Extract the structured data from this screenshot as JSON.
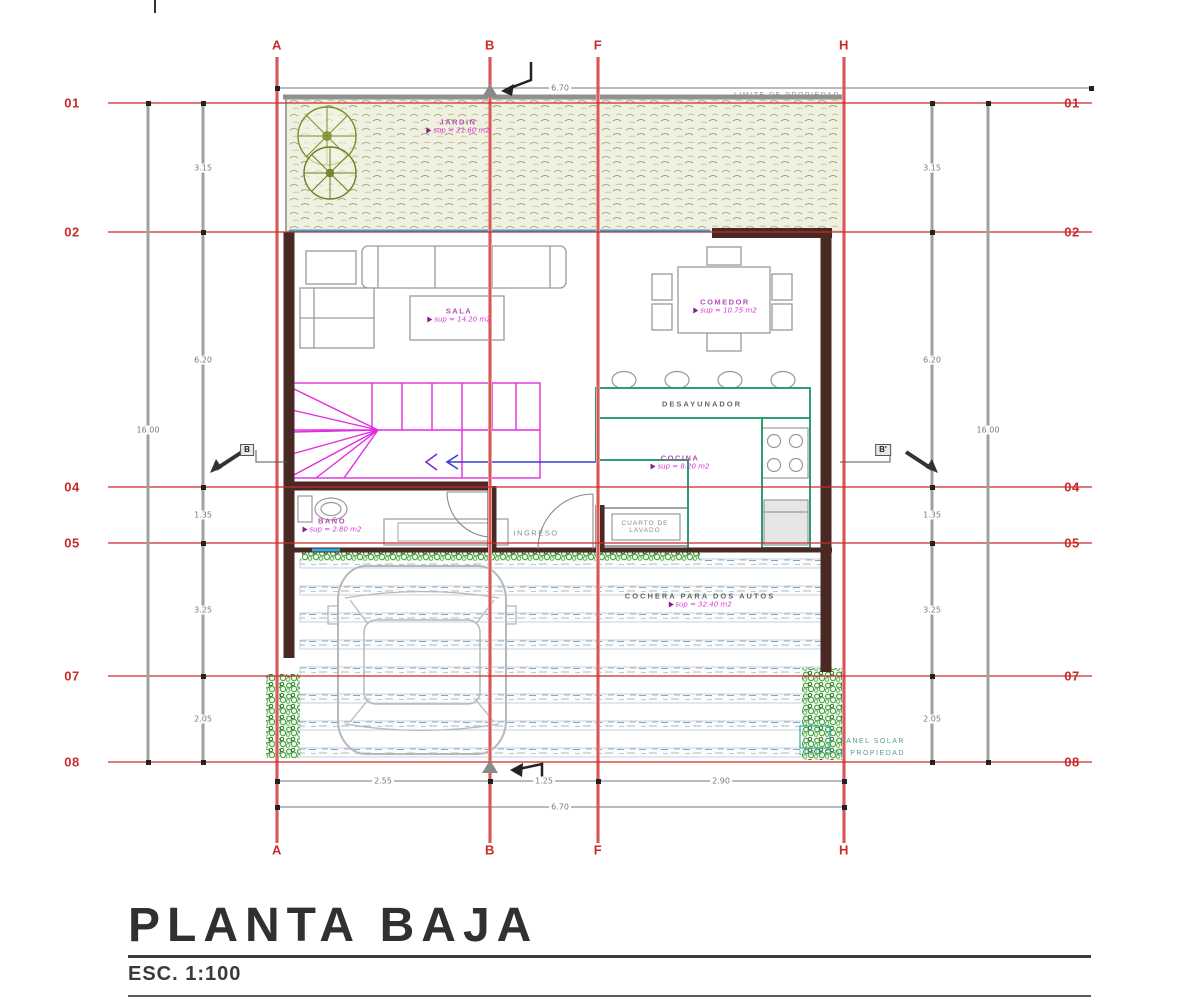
{
  "title_block": {
    "title": "PLANTA BAJA",
    "scale": "ESC. 1:100"
  },
  "grid": {
    "cols": [
      "A",
      "B",
      "F",
      "H"
    ],
    "rows": [
      "01",
      "02",
      "04",
      "05",
      "07",
      "08"
    ]
  },
  "dims": {
    "left": [
      "3.15",
      "6.20",
      "1.35",
      "3.25",
      "2.05"
    ],
    "left_total": "16.00",
    "right": [
      "3.15",
      "6.20",
      "1.35",
      "3.25",
      "2.05"
    ],
    "right_total": "16.00",
    "bottom": [
      "2.55",
      "1.25",
      "2.90"
    ],
    "bottom_total": "6.70",
    "top_total": "6.70"
  },
  "rooms": {
    "jardin": {
      "name": "JARDIN",
      "area": "sup = 21.60 m2"
    },
    "sala": {
      "name": "SALA",
      "area": "sup = 14.20 m2"
    },
    "comedor": {
      "name": "COMEDOR",
      "area": "sup = 10.75 m2"
    },
    "desayunador": {
      "name": "DESAYUNADOR"
    },
    "cocina": {
      "name": "COCINA",
      "area": "sup = 8.20 m2"
    },
    "bano": {
      "name": "BAÑO",
      "area": "sup = 2.80 m2"
    },
    "ingreso": {
      "name": "INGRESO"
    },
    "lavado": {
      "name": "CUARTO DE LAVADO"
    },
    "cochera": {
      "name": "COCHERA PARA DOS AUTOS",
      "area": "sup = 32.40 m2"
    }
  },
  "annotations": {
    "limite_top": "LIMITE DE PROPIEDAD",
    "panel_solar": "PANEL SOLAR",
    "limite_bottom": "LIMITE DE PROPIEDAD"
  },
  "sections": {
    "left": "B",
    "right": "B'"
  },
  "colors": {
    "grid_red": "#cc2a2a",
    "wall": "#4a2823",
    "stair": "#e22ae2",
    "counter": "#2e9e6e",
    "window": "#2fa8d8",
    "label": "#d935d9"
  }
}
